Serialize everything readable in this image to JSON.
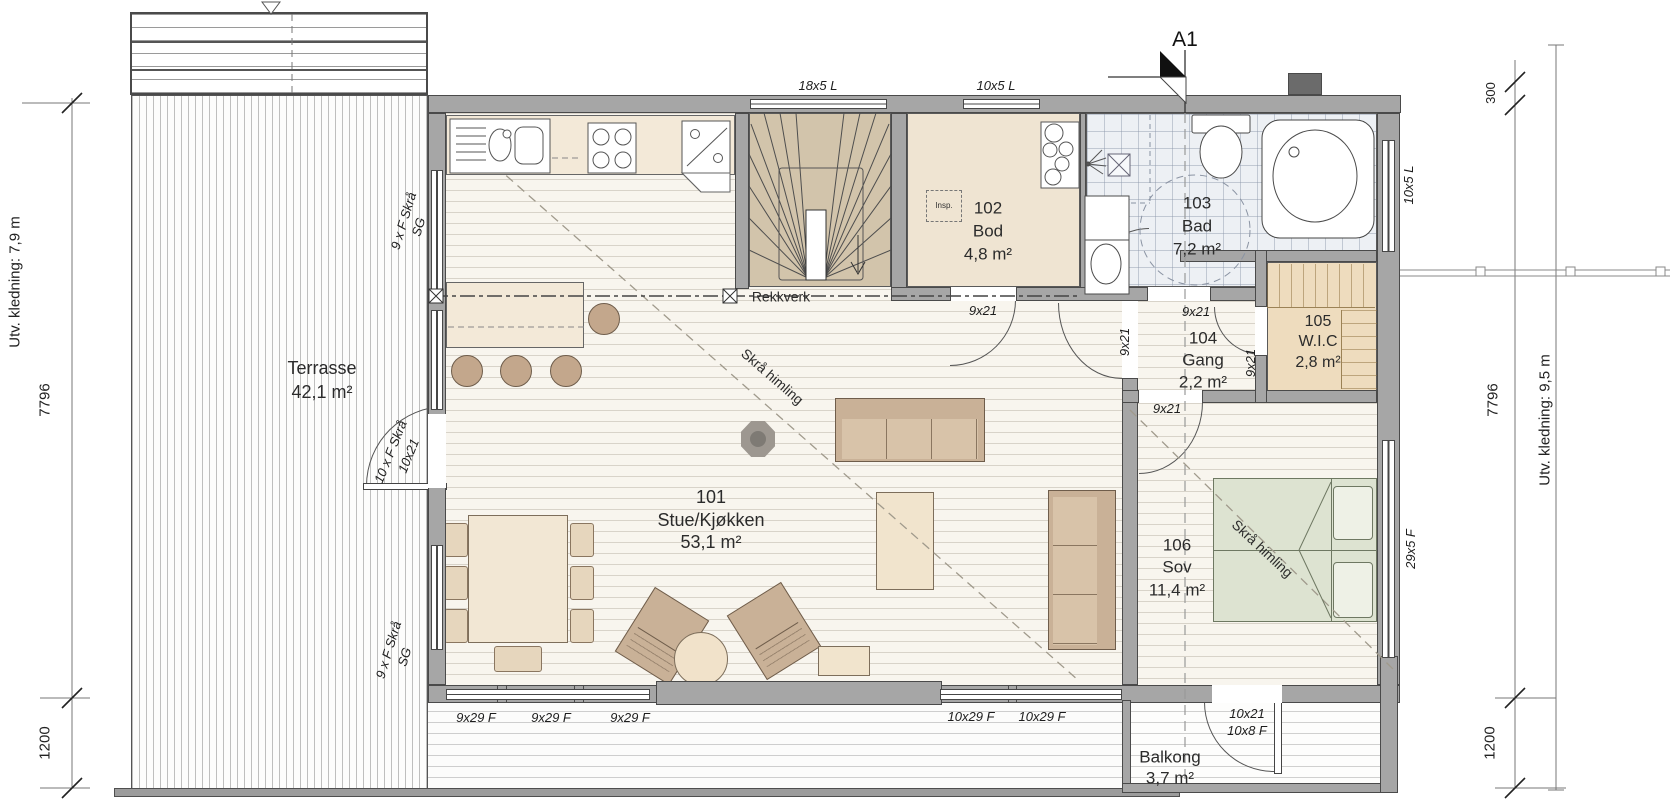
{
  "plan": {
    "section_label": "A1",
    "rooms": [
      {
        "number": "101",
        "name": "Stue/Kjøkken",
        "area": "53,1 m²"
      },
      {
        "number": "102",
        "name": "Bod",
        "area": "4,8 m²"
      },
      {
        "number": "103",
        "name": "Bad",
        "area": "7,2 m²"
      },
      {
        "number": "104",
        "name": "Gang",
        "area": "2,2 m²"
      },
      {
        "number": "105",
        "name": "W.I.C",
        "area": "2,8 m²"
      },
      {
        "number": "106",
        "name": "Sov",
        "area": "11,4 m²"
      }
    ],
    "terrace": {
      "name": "Terrasse",
      "area": "42,1 m²"
    },
    "balcony": {
      "name": "Balkong",
      "area": "3,7 m²"
    },
    "annotations": {
      "railing": "Rekkverk",
      "sloped_ceiling": "Skrå himling",
      "inspection": "Insp."
    },
    "dimensions": {
      "left_total": "7796",
      "left_lower": "1200",
      "left_cladding": "Utv. kledning: 7,9 m",
      "right_offset": "300",
      "right_total": "7796",
      "right_lower": "1200",
      "right_cladding": "Utv. kledning: 9,5 m"
    },
    "openings": {
      "top_window_large": "18x5 L",
      "top_window_small": "10x5 L",
      "east_window_bath": "10x5 L",
      "east_window_bedroom": "29x5 F",
      "south_window": "9x29 F",
      "south_window_wide": "10x29 F",
      "balcony_door": "10x21",
      "balcony_window": "10x8 F",
      "terrace_door_type": "10 x F Skrå",
      "terrace_door_size": "10x21",
      "west_window_type": "9 x F Skrå",
      "west_window_glass": "SG",
      "interior_door": "9x21"
    },
    "colors": {
      "wall": "#a6a6a6",
      "room_beige": "#efe4d2",
      "tile": "#edf0f4",
      "bed_green": "#dde3d1",
      "furniture_tan": "#c9b197"
    }
  }
}
